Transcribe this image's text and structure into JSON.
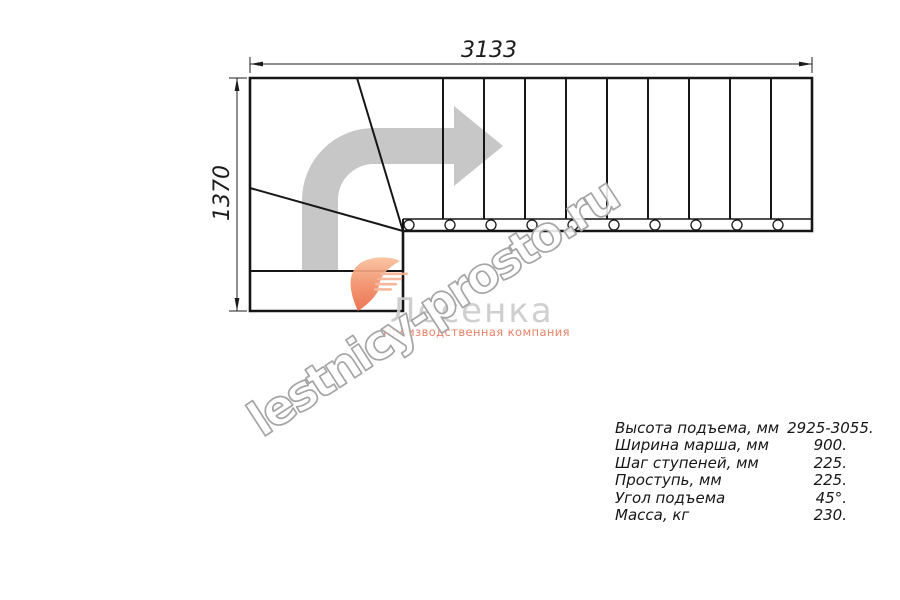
{
  "drawing": {
    "width_label": "3133",
    "height_label": "1370"
  },
  "logo": {
    "name": "Лесенка",
    "subtitle": "Производственная компания",
    "accent_color": "#ee6f4a",
    "text_color": "#cbcbcb"
  },
  "watermark": {
    "text": "lestnicy-prosto.ru",
    "outline_color": "#a5a5a5"
  },
  "specs": {
    "rows": [
      {
        "label": "Высота подъема, мм",
        "value": "2925-3055."
      },
      {
        "label": "Ширина марша, мм",
        "value": "900."
      },
      {
        "label": "Шаг ступеней, мм",
        "value": "225."
      },
      {
        "label": "Проступь, мм",
        "value": "225."
      },
      {
        "label": "Угол подъема",
        "value": "45°."
      },
      {
        "label": "Масса, кг",
        "value": "230."
      }
    ]
  },
  "colors": {
    "line": "#161616",
    "direction_arrow": "#c7c7c7"
  }
}
